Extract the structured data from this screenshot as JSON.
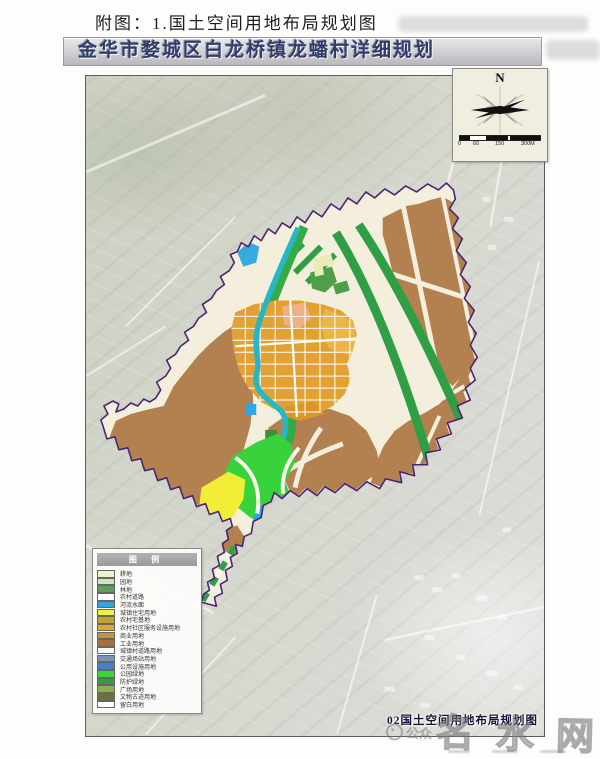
{
  "page": {
    "title": "附图：1.国土空间用地布局规划图"
  },
  "map": {
    "header": "金华市婺城区白龙桥镇龙蟠村详细规划",
    "caption": "02国土空间用地布局规划图",
    "compass_label": "N",
    "scale_ticks": [
      "0",
      "60",
      "150",
      "300M"
    ],
    "legend": {
      "title": "图 例",
      "items": [
        {
          "label": "耕地",
          "color": "#f2eed2"
        },
        {
          "label": "园地",
          "color": "#cde6bd"
        },
        {
          "label": "林地",
          "color": "#5aa05b"
        },
        {
          "label": "农村道路",
          "color": "#ffffff"
        },
        {
          "label": "河流水面",
          "color": "#30a4dc"
        },
        {
          "label": "城镇住宅用地",
          "color": "#f2ee45"
        },
        {
          "label": "农村宅基地",
          "color": "#bfa435"
        },
        {
          "label": "农村社区服务设施用地",
          "color": "#e2a52f"
        },
        {
          "label": "商业用地",
          "color": "#c39440"
        },
        {
          "label": "工业用地",
          "color": "#a3703f"
        },
        {
          "label": "城镇村道路用地",
          "color": "#f7f7f3"
        },
        {
          "label": "交通场站用地",
          "color": "#7d94b6"
        },
        {
          "label": "公用设施用地",
          "color": "#3f83c9"
        },
        {
          "label": "公园绿地",
          "color": "#3fd23f"
        },
        {
          "label": "防护绿地",
          "color": "#2f9e44"
        },
        {
          "label": "广场用地",
          "color": "#8fae53"
        },
        {
          "label": "文物古迹用地",
          "color": "#6d713d"
        },
        {
          "label": "留白用地",
          "color": "#ffffff"
        }
      ]
    }
  },
  "watermark": {
    "prefix": "公众",
    "text": "名水网"
  },
  "colors": {
    "boundary": "#4b2570",
    "farmland_brown": "#b3804f",
    "village_orange": "#e2a233",
    "greenbelt": "#2f9e44",
    "river_teal": "#27b6c4"
  }
}
